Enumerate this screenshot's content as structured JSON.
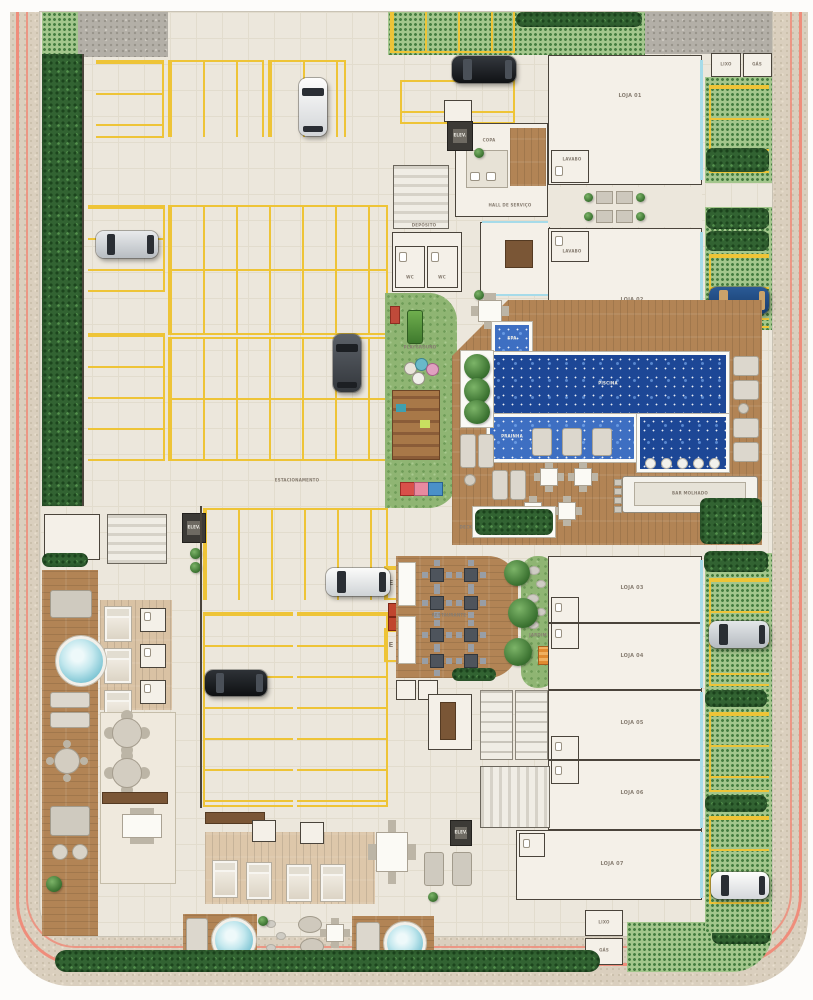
{
  "labels": {
    "loja01": "LOJA 01",
    "loja02": "LOJA 02",
    "loja03": "LOJA 03",
    "loja04": "LOJA 04",
    "loja05": "LOJA 05",
    "loja06": "LOJA 06",
    "loja07": "LOJA 07",
    "wc": "WC",
    "lavabo": "LAVABO",
    "elevador": "ELEV.",
    "deposito": "DEPÓSITO",
    "hall": "HALL DE SERVIÇO",
    "copa": "COPA",
    "lixo": "LIXO",
    "gas": "GÁS",
    "piscina": "PISCINA",
    "prainha": "PRAINHA",
    "spa": "SPA",
    "bar": "BAR MOLHADO",
    "deck": "DECK",
    "playground": "PLAYGROUND",
    "restaurante": "RESTAURANTE",
    "jardim": "JARDIM",
    "estacionamento": "ESTACIONAMENTO",
    "ev": "E"
  },
  "colors": {
    "wall": "#4a443b",
    "floor": "#ece7dc",
    "floorGrid": "#e2dccd",
    "room": "#f4f0e8",
    "yellow": "#eec437",
    "sidewalk": "#dacfbe",
    "redline": "#ef8d7b",
    "pavers": "#a3c68c",
    "paversDot": "#477e41",
    "hedge": "#326332",
    "lawn": "#8fb573",
    "wood": "#b28455",
    "pool": "#1d4796",
    "pool2": "#3e6fc2",
    "concrete": "#b3afa7",
    "glass": "#a6dbe9",
    "label": "#87randomness7d71"
  }
}
